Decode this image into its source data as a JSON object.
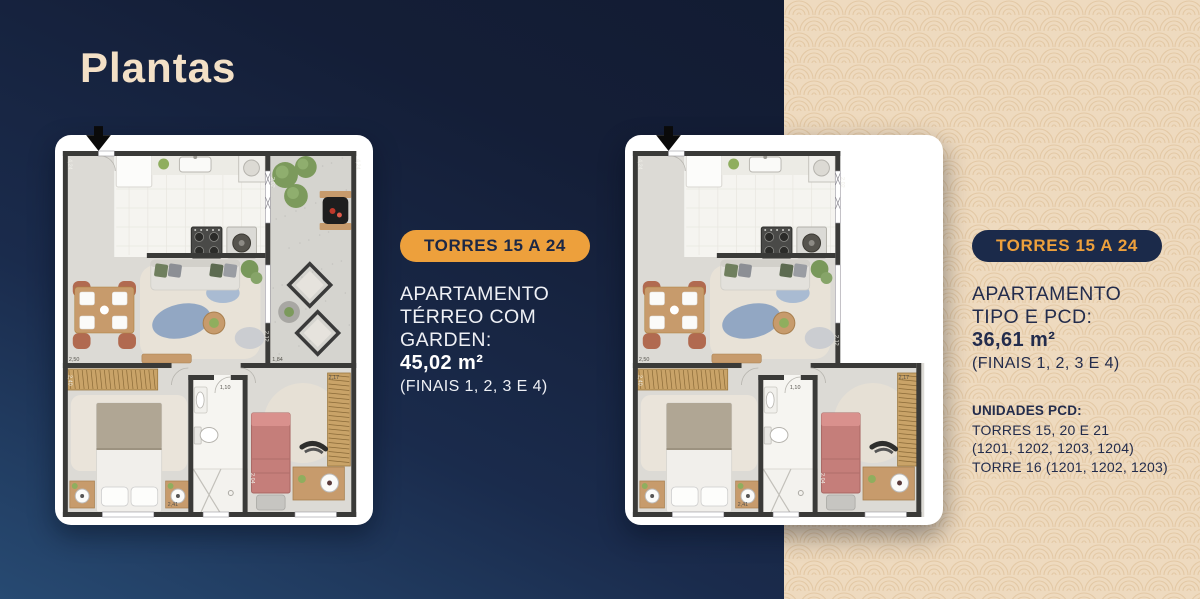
{
  "title": "Plantas",
  "left_panel": {
    "badge": "TORRES 15 A 24",
    "desc_lines": [
      "APARTAMENTO",
      "TÉRREO COM",
      "GARDEN:"
    ],
    "area": "45,02 m²",
    "finais": "(FINAIS 1, 2, 3 E 4)"
  },
  "right_panel": {
    "badge": "TORRES 15 A 24",
    "desc_lines": [
      "APARTAMENTO",
      "TIPO E PCD:"
    ],
    "area": "36,61 m²",
    "finais": "(FINAIS 1, 2, 3 E 4)",
    "pcd_title": "UNIDADES PCD:",
    "pcd_lines": [
      "TORRES 15, 20 E 21",
      "(1201, 1202, 1203, 1204)",
      "TORRE 16 (1201, 1202, 1203)"
    ]
  },
  "colors": {
    "navy_dark": "#121a2f",
    "navy_light": "#274a72",
    "cream": "#eedabf",
    "cream_line": "#dfc29b",
    "accent_orange": "#eda03c",
    "badge_navy": "#1b2a4a",
    "text_light": "#eef0f5",
    "text_dark": "#232c4c",
    "wall": "#3a3a38",
    "floor": "#dcdad5",
    "kitchen_floor": "#f5f4f0",
    "concrete": "#d5d4cf",
    "wood": "#c79b6c",
    "terracotta": "#b16a50",
    "bed_pink": "#c57e7a",
    "wardrobe": "#c9a368"
  },
  "floorplans": {
    "left": {
      "name": "apartamento-terreo-com-garden",
      "garden": true,
      "labels": [
        {
          "t": "4,24",
          "x": 13.5,
          "y": 24,
          "v": true,
          "c": "light"
        },
        {
          "t": "2,02",
          "x": 218.5,
          "y": 42,
          "v": true,
          "c": "light"
        },
        {
          "t": "4,24",
          "x": 305.5,
          "y": 24,
          "v": true,
          "c": "light"
        },
        {
          "t": "2,50",
          "x": 14,
          "y": 226,
          "c": "dark"
        },
        {
          "t": "2,40",
          "x": 13.5,
          "y": 240,
          "v": true,
          "c": "light"
        },
        {
          "t": "2,12",
          "x": 212.5,
          "y": 196,
          "v": true,
          "c": "light"
        },
        {
          "t": "1,84",
          "x": 220,
          "y": 226,
          "c": "dark"
        },
        {
          "t": "2,17",
          "x": 277,
          "y": 244,
          "c": "dark"
        },
        {
          "t": "1,10",
          "x": 167,
          "y": 254,
          "c": "dark"
        },
        {
          "t": "2,41",
          "x": 114,
          "y": 371,
          "c": "dark"
        },
        {
          "t": "2,04",
          "x": 198.5,
          "y": 338,
          "v": true,
          "c": "light"
        }
      ]
    },
    "right": {
      "name": "apartamento-tipo-e-pcd",
      "garden": false,
      "labels": [
        {
          "t": "4,24",
          "x": 13.5,
          "y": 24,
          "v": true,
          "c": "light"
        },
        {
          "t": "2,02",
          "x": 218.5,
          "y": 42,
          "v": true,
          "c": "light"
        },
        {
          "t": "2,50",
          "x": 14,
          "y": 226,
          "c": "dark"
        },
        {
          "t": "2,40",
          "x": 13.5,
          "y": 240,
          "v": true,
          "c": "light"
        },
        {
          "t": "2,12",
          "x": 212.5,
          "y": 200,
          "v": true,
          "c": "light"
        },
        {
          "t": "2,17",
          "x": 277,
          "y": 244,
          "c": "dark"
        },
        {
          "t": "1,10",
          "x": 167,
          "y": 254,
          "c": "dark"
        },
        {
          "t": "2,41",
          "x": 114,
          "y": 371,
          "c": "dark"
        },
        {
          "t": "2,04",
          "x": 198.5,
          "y": 338,
          "v": true,
          "c": "light"
        }
      ]
    }
  }
}
